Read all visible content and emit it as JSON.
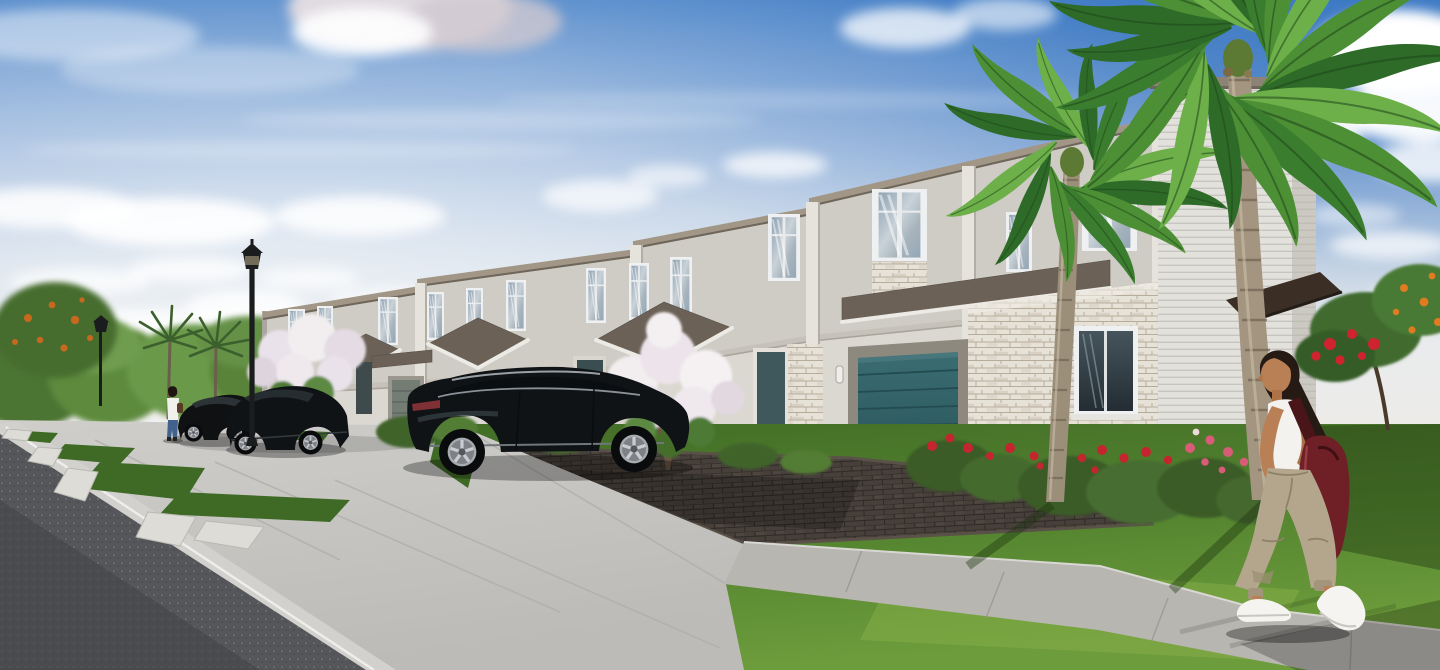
{
  "scene": {
    "type": "exterior-architectural-rendering",
    "time_of_day": "day",
    "description": "Photorealistic rendering of a row of two-story light-gray stucco townhomes with stacked-stone accents, brown shingle porch gables, a dark teal single garage door, tall second-floor windows reflecting clouds, a dark luxury SUV and two dark cars parked along a concrete parking apron with white wheel stops, black lantern street lamps, crepe myrtle trees with white blossoms, shrubs with red and pink flowers, two large coconut palms in the right foreground, a woman in a white tank top, khaki cargo pants and white sneakers carrying a maroon shoulder bag walking left along a sunlit sidewalk, a second distant woman walking near the parked cars, blue sky with cumulus clouds."
  },
  "objects": [
    "sky",
    "clouds",
    "background-treeline",
    "distant-rooftops",
    "picket-fence",
    "townhome-row",
    "cornice",
    "upper-windows",
    "stone-veneer",
    "porch-gables",
    "entry-doors",
    "teal-garage-door",
    "far-garage-door",
    "wall-sconces",
    "siding-tower",
    "entry-awning",
    "asphalt-road",
    "curb",
    "parking-apron",
    "wheel-stops",
    "grass-strips",
    "paver-driveway",
    "sidewalk",
    "lawn",
    "flower-shrubs",
    "crepe-myrtle-trees",
    "poinciana-tree",
    "orange-fruit-tree",
    "sedan",
    "crossover",
    "suv",
    "street-lamp-large",
    "street-lamp-small",
    "palm-trunks",
    "palm-crowns",
    "walking-woman",
    "distant-woman"
  ],
  "colors": {
    "sky_top": "#3d7ac4",
    "sky_mid": "#8fafd8",
    "sky_horizon": "#e9ebec",
    "cloud": "#ffffff",
    "stucco": "#cfccc5",
    "stucco_light": "#e0ddd6",
    "stucco_shadow": "#b7b3ab",
    "cornice": "#a29787",
    "roof_shingle": "#6b6156",
    "stone": "#e7e2d8",
    "siding": "#e3e1dc",
    "garage_teal": "#2e5e63",
    "door_teal": "#3f585c",
    "far_garage": "#747d74",
    "awning": "#3a2e25",
    "window_frame": "#eef0f1",
    "glass": "#9fb2c0",
    "asphalt": "#55565a",
    "curb": "#d2d1cd",
    "concrete": "#c7c6c3",
    "sidewalk": "#b8b6b1",
    "paver": "#47403a",
    "grass": "#4f7c2c",
    "grass_light": "#79a540",
    "grass_dark": "#2e5220",
    "foliage": "#5d8a3c",
    "palm_frond": "#4c8f35",
    "palm_trunk": "#a3957f",
    "flower_red": "#c5252f",
    "flower_pink": "#d85b77",
    "flower_white": "#efe9ee",
    "flower_orange": "#df7b22",
    "car_dark": "#101315",
    "wheel_silver": "#b9bcc0",
    "skin": "#b97f55",
    "hair": "#261a14",
    "top_white": "#f4f2ee",
    "pants_khaki": "#b3a68c",
    "bag_maroon": "#6e2026",
    "shoe_white": "#f5f4f1",
    "lamp_black": "#1b1c1e"
  },
  "counts": {
    "upper_windows": 13,
    "vehicles": 3,
    "street_lamps": 2,
    "people": 2,
    "foreground_palms": 2,
    "wheel_stops": 5
  }
}
